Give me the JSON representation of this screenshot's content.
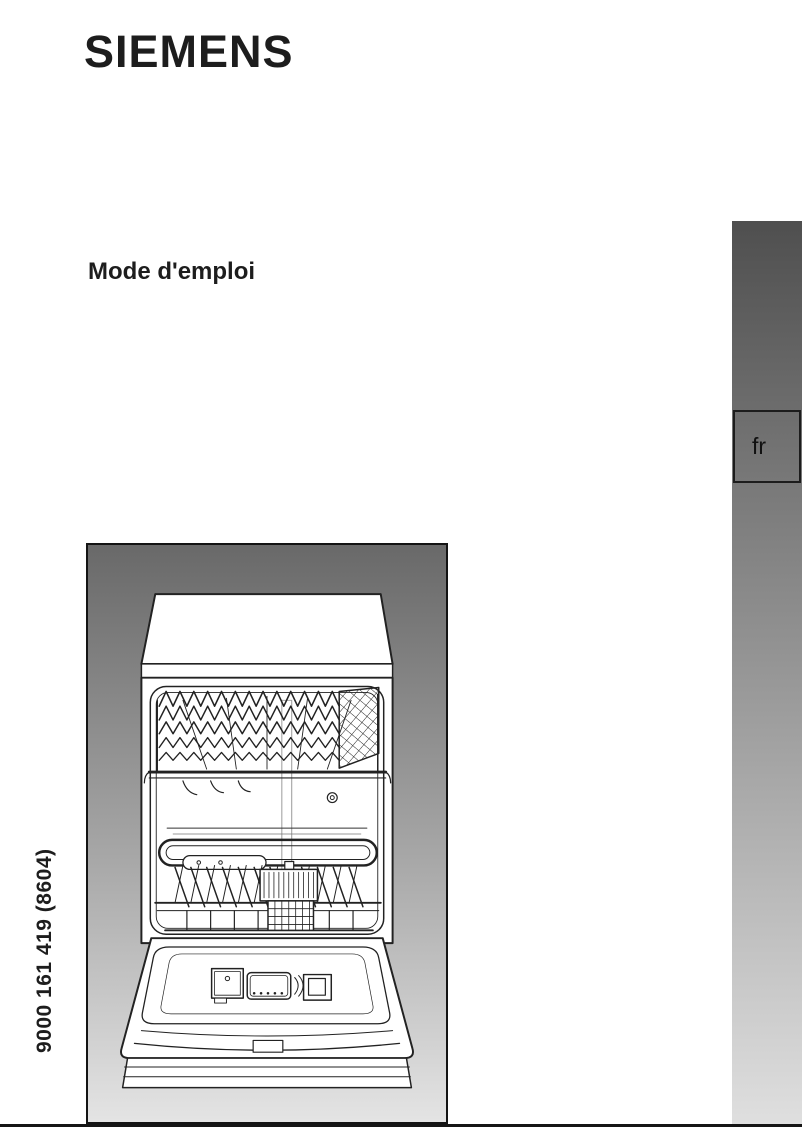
{
  "document": {
    "brand": "SIEMENS",
    "title": "Mode d'emploi",
    "language_tab": "fr",
    "order_number": "9000 161 419 (8604)"
  },
  "figure": {
    "icon": "dishwasher-open-front-illustration"
  },
  "colors": {
    "text": "#1d1d1d",
    "sidebar_gradient_top": "#4f4f4f",
    "sidebar_gradient_bottom": "#dfdfdf",
    "figure_gradient_top": "#696969",
    "figure_gradient_bottom": "#e4e4e4",
    "line_art": "#222222",
    "bottom_rule": "#151515"
  }
}
